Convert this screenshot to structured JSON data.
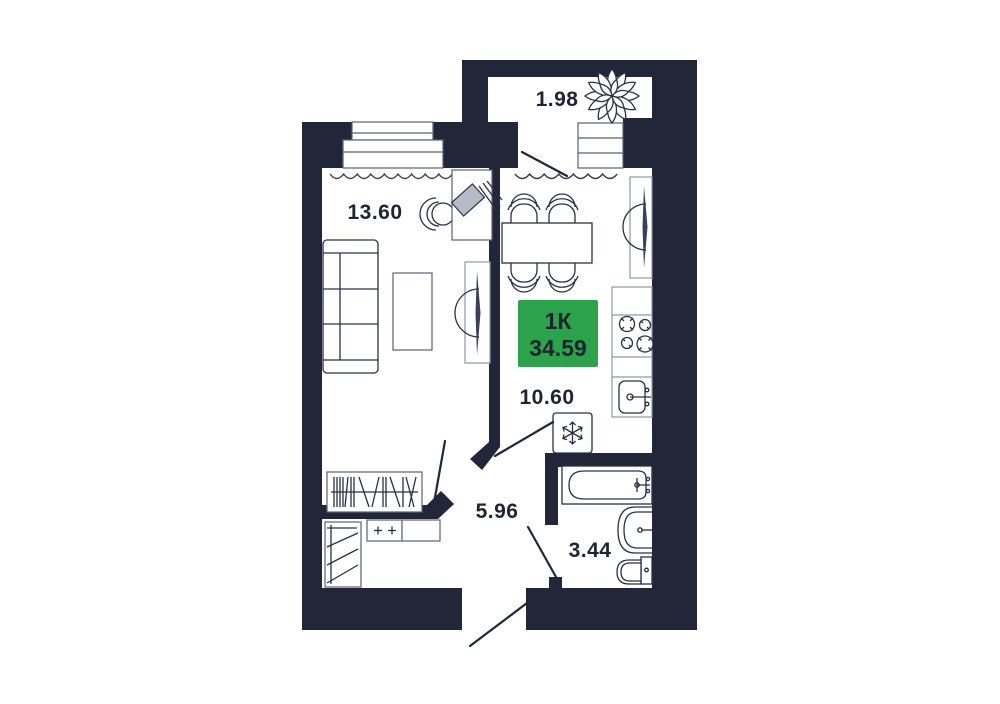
{
  "badge": {
    "rooms_label": "1К",
    "total_area": "34.59",
    "color": "#2ca24d"
  },
  "areas": {
    "balcony": "1.98",
    "living_room": "13.60",
    "kitchen": "10.60",
    "hallway": "5.96",
    "bathroom": "3.44"
  },
  "colors": {
    "wall": "#212639",
    "label_text": "#1f2333",
    "badge_text": "#1d2431"
  },
  "icons": {
    "balcony_plant": "plant-icon",
    "fridge": "snowflake-icon",
    "stove": "burners-icon",
    "tv": "tv-icon"
  }
}
